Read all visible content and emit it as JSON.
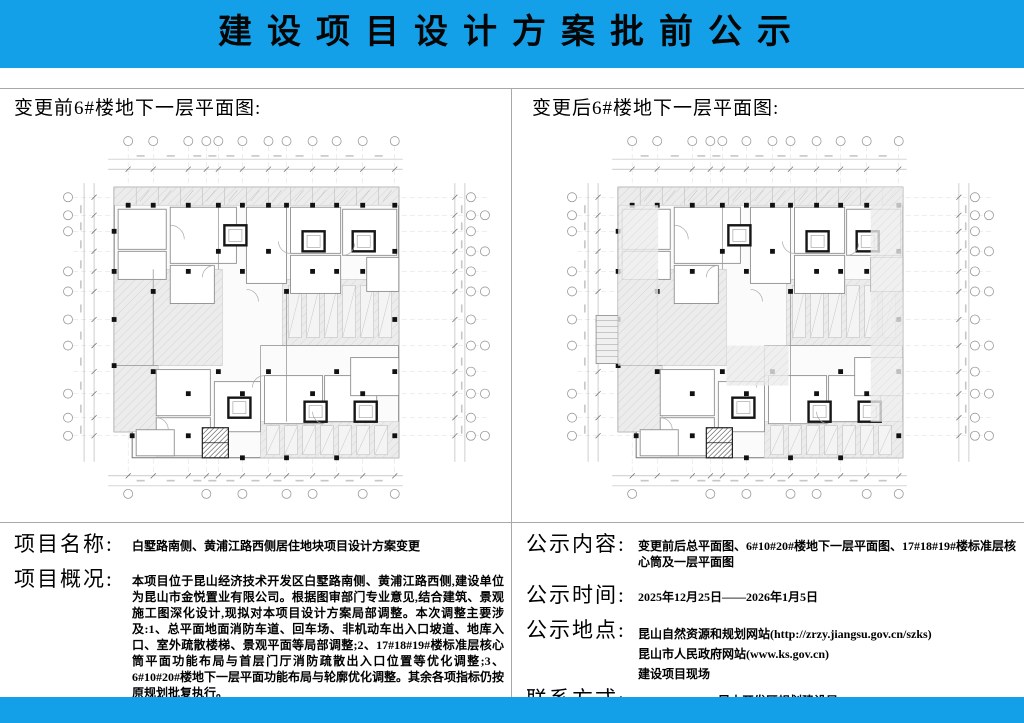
{
  "colors": {
    "accent_blue": "#14A0E9",
    "divider_gray": "#A8A8A8"
  },
  "header": {
    "title": "建设项目设计方案批前公示"
  },
  "plans": {
    "before_caption": "变更前6#楼地下一层平面图:",
    "after_caption": "变更后6#楼地下一层平面图:"
  },
  "project": {
    "name_label": "项目名称:",
    "name_value": "白墅路南侧、黄浦江路西侧居住地块项目设计方案变更",
    "overview_label": "项目概况:",
    "overview_value": "本项目位于昆山经济技术开发区白墅路南侧、黄浦江路西侧,建设单位为昆山市金悦置业有限公司。根据图审部门专业意见,结合建筑、景观施工图深化设计,现拟对本项目设计方案局部调整。本次调整主要涉及:1、总平面地面消防车道、回车场、非机动车出入口坡道、地库入口、室外疏散楼梯、景观平面等局部调整;2、17#18#19#楼标准层核心筒平面功能布局与首层门厅消防疏散出入口位置等优化调整;3、6#10#20#楼地下一层平面功能布局与轮廓优化调整。其余各项指标仍按原规划批复执行。"
  },
  "notice": {
    "content_label": "公示内容:",
    "content_value": "变更前后总平面图、6#10#20#楼地下一层平面图、17#18#19#楼标准层核心筒及一层平面图",
    "time_label": "公示时间:",
    "time_value": "2025年12月25日——2026年1月5日",
    "place_label": "公示地点:",
    "place_line1": "昆山自然资源和规划网站(http://zrzy.jiangsu.gov.cn/szks)",
    "place_line2": "昆山市人民政府网站(www.ks.gov.cn)",
    "place_line3": "建设项目现场",
    "contact_label": "联系方式:",
    "contact_value": "0512-50197590(昆山开发区规划建设局)"
  }
}
